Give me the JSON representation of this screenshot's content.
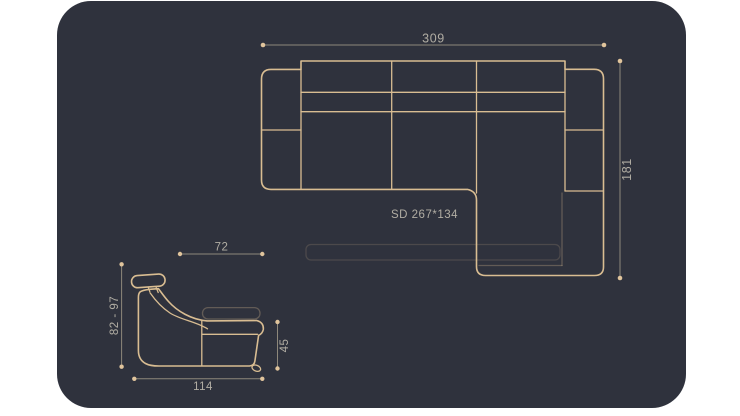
{
  "colors": {
    "page_bg": "#ffffff",
    "panel_bg": "#2f323d",
    "line_color": "#d9bd92",
    "dim_line_color": "#8e887b",
    "dot_color": "#e0c49c",
    "text_color": "#b1ada3"
  },
  "top_view": {
    "width_dim_label": "309",
    "depth_dim_label": "181",
    "bed_size_label": "SD 267*134"
  },
  "side_view": {
    "upper_depth_dim_label": "72",
    "height_range_dim_label": "82 - 97",
    "seat_height_dim_label": "45",
    "base_depth_dim_label": "114"
  }
}
